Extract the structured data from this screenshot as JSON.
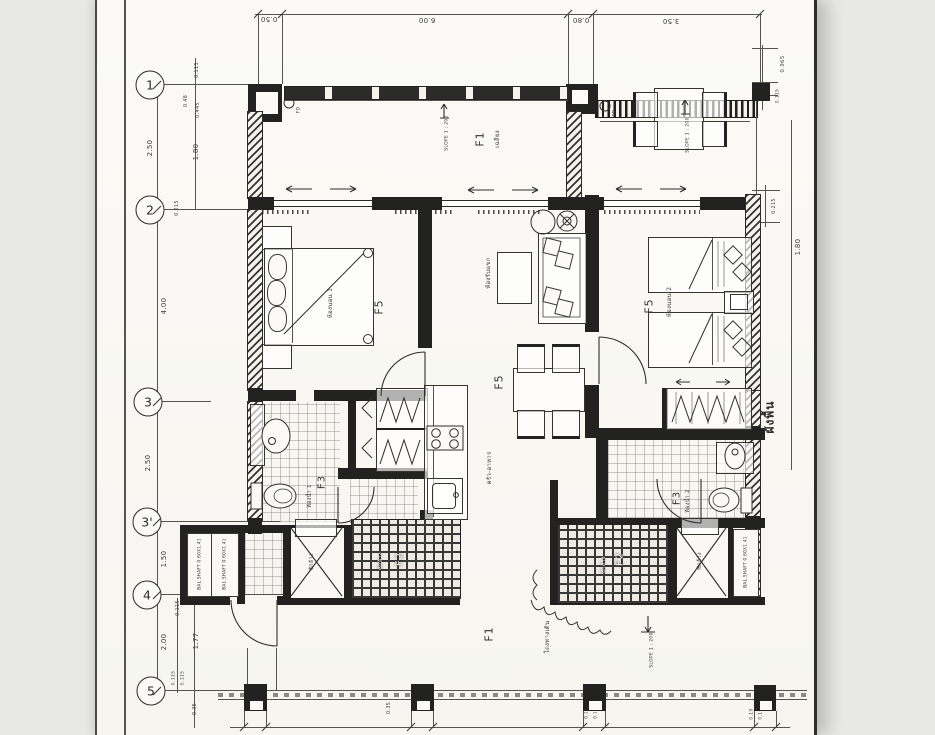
{
  "page": {
    "bg": "#e8e8e7",
    "paper": "#fbfaf6",
    "ink": "#2c2c2a"
  },
  "grid_bubbles": [
    {
      "label": "1"
    },
    {
      "label": "2"
    },
    {
      "label": "3"
    },
    {
      "label": "3'"
    },
    {
      "label": "4"
    },
    {
      "label": "5"
    }
  ],
  "dims": {
    "top": [
      {
        "v": "0.50"
      },
      {
        "v": "6.00"
      },
      {
        "v": "0.80"
      },
      {
        "v": "3.50"
      }
    ],
    "left": [
      {
        "v": "0.115"
      },
      {
        "v": "0.48"
      },
      {
        "v": "0.445"
      },
      {
        "v": "2.50"
      },
      {
        "v": "1.80"
      },
      {
        "v": "0.215"
      },
      {
        "v": "4.00"
      },
      {
        "v": "2.50"
      },
      {
        "v": "1.50"
      },
      {
        "v": "0.115"
      },
      {
        "v": "2.00"
      },
      {
        "v": "1.77"
      },
      {
        "v": "0.115"
      },
      {
        "v": "0.115"
      },
      {
        "v": "0.35"
      }
    ],
    "right": [
      {
        "v": "0.965"
      },
      {
        "v": "0.115"
      },
      {
        "v": "0.215"
      },
      {
        "v": "1.80"
      },
      {
        "v": "0.19"
      },
      {
        "v": "0.19"
      }
    ],
    "bottom": [
      {
        "v": "0.35"
      },
      {
        "v": "0.165"
      },
      {
        "v": "0.165"
      }
    ]
  },
  "rooms": {
    "balcony": {
      "code": "F1",
      "name": "เฉลียง"
    },
    "bedroom1": {
      "code": "F5",
      "name": "ห้องนอน 1"
    },
    "bedroom2": {
      "code": "F5",
      "name": "ห้องนอน 2"
    },
    "living": {
      "name": "ห้องรับแขก"
    },
    "dining": {
      "code": "F5"
    },
    "kitchen": {
      "name": "ครัว-อาหาร"
    },
    "bath1": {
      "code": "F3",
      "name": "ห้องน้ำ 1"
    },
    "bath2": {
      "code": "F3",
      "name": "ห้องน้ำ 2"
    },
    "laundry_left": {
      "code": "F2",
      "name": "ซักล้าง"
    },
    "laundry_right": {
      "code": "F2",
      "name": "ซักล้าง"
    },
    "wash_left": {
      "name": "ซักล้าง"
    },
    "wash_right": {
      "name": "ซักล้าง"
    },
    "corridor": {
      "code": "F1",
      "name": "โถงทางเดิน"
    }
  },
  "annotations": {
    "slope": "SLOPE 1 : 200",
    "fd": "FD",
    "shaft": "BAL.SHAFT 0.60X1.41",
    "sheet_title": "ผังพื้น"
  }
}
